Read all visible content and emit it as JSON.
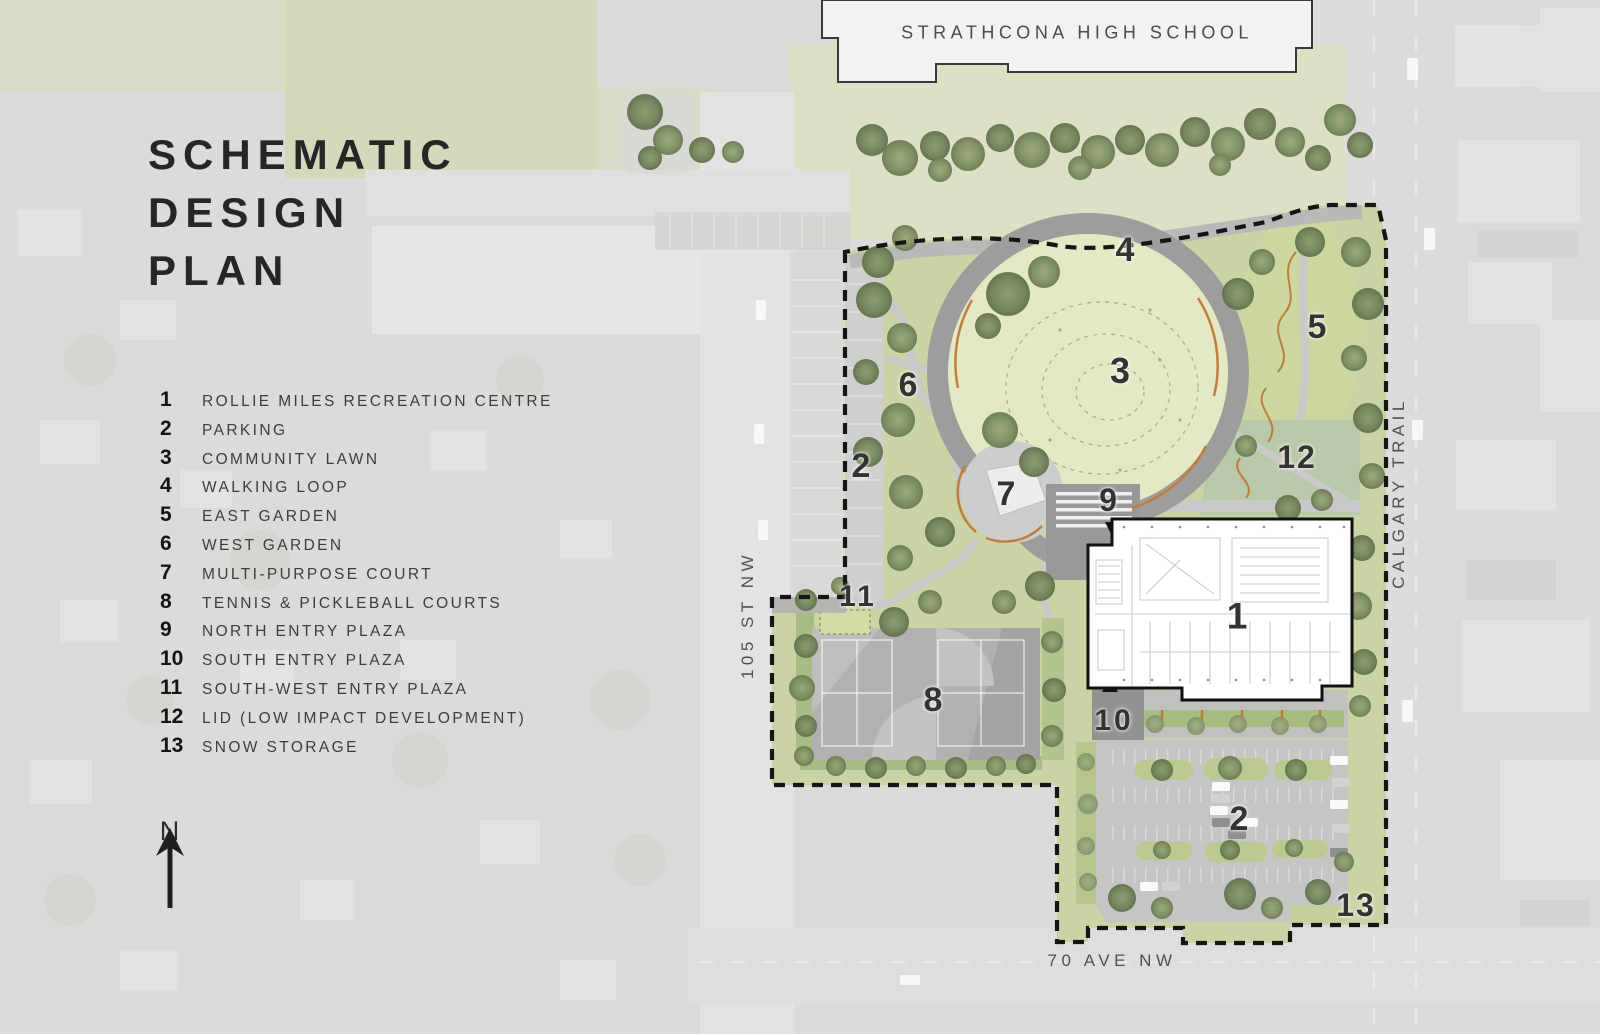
{
  "title": {
    "lines": [
      "SCHEMATIC",
      "DESIGN",
      "PLAN"
    ]
  },
  "legend": {
    "items": [
      {
        "num": "1",
        "label": "ROLLIE MILES RECREATION CENTRE"
      },
      {
        "num": "2",
        "label": "PARKING"
      },
      {
        "num": "3",
        "label": "COMMUNITY LAWN"
      },
      {
        "num": "4",
        "label": "WALKING LOOP"
      },
      {
        "num": "5",
        "label": "EAST GARDEN"
      },
      {
        "num": "6",
        "label": "WEST GARDEN"
      },
      {
        "num": "7",
        "label": "MULTI-PURPOSE COURT"
      },
      {
        "num": "8",
        "label": "TENNIS & PICKLEBALL COURTS"
      },
      {
        "num": "9",
        "label": "NORTH ENTRY PLAZA"
      },
      {
        "num": "10",
        "label": "SOUTH ENTRY PLAZA"
      },
      {
        "num": "11",
        "label": "SOUTH-WEST ENTRY PLAZA"
      },
      {
        "num": "12",
        "label": "LID (LOW IMPACT DEVELOPMENT)"
      },
      {
        "num": "13",
        "label": "SNOW STORAGE"
      }
    ]
  },
  "labels": {
    "school": "STRATHCONA HIGH SCHOOL",
    "street_105": "105 ST NW",
    "calgary_trail": "CALGARY TRAIL",
    "ave_70": "70 AVE NW"
  },
  "compass": {
    "label": "N"
  },
  "plan_markers": [
    {
      "num": "1"
    },
    {
      "num": "2"
    },
    {
      "num": "2"
    },
    {
      "num": "3"
    },
    {
      "num": "4"
    },
    {
      "num": "5"
    },
    {
      "num": "6"
    },
    {
      "num": "7"
    },
    {
      "num": "8"
    },
    {
      "num": "9"
    },
    {
      "num": "10"
    },
    {
      "num": "11"
    },
    {
      "num": "12"
    },
    {
      "num": "13"
    }
  ],
  "colors": {
    "boundary_dash": "#151515",
    "park_green": "#c9d3a3",
    "lawn": "#e4e8c4",
    "tree_olive": "#6e7e56",
    "loop_gray": "#9d9d9b",
    "court_gray": "#b1b1af",
    "parking_gray": "#c5c5c3",
    "building_white": "#ffffff",
    "orange_accent": "#bf7e3e",
    "text_dark": "#262626"
  }
}
